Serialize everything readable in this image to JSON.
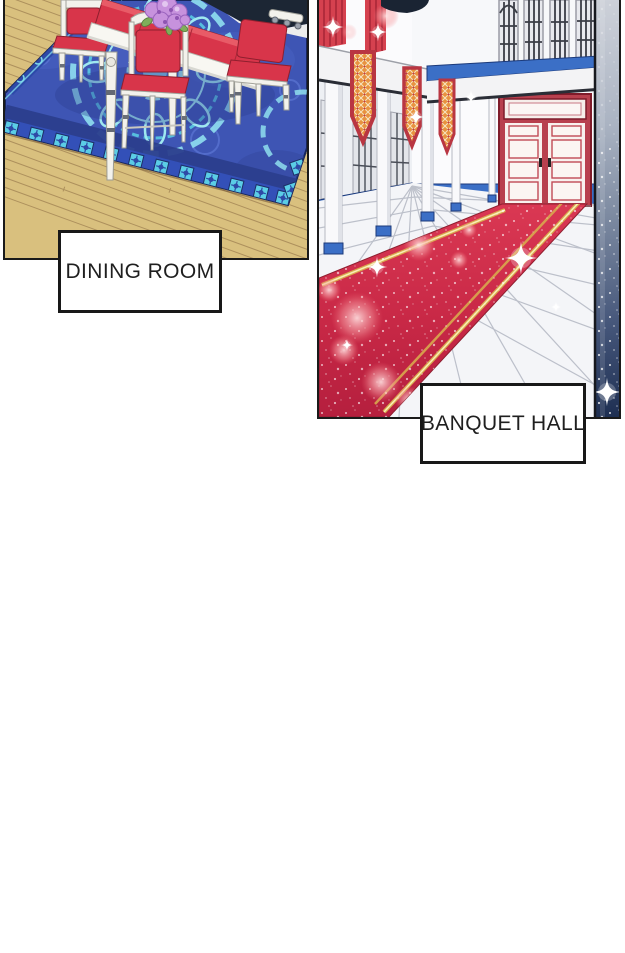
{
  "page": {
    "background": "#ffffff",
    "kind": "comic-page",
    "bottom_area": "blank-white"
  },
  "panels": [
    {
      "id": "dining-room",
      "caption": "DINING ROOM",
      "scene": "dining room with white table and chairs, red cushions, purple flower bouquet, ornate royal-blue carpet with cyan tile border on a tan wooden plank floor"
    },
    {
      "id": "banquet-hall",
      "caption": "BANQUET HALL",
      "scene": "palace banquet hall with white colonnade pillars, hanging orange lattice pennant banners, red curtains, barred windows, red double door, sparkling red carpet with gold trim on white tile floor, starry gradient strip at right edge"
    }
  ],
  "colors": {
    "panel_border": "#1a1a1a",
    "caption_background": "#ffffff",
    "caption_text": "#1f1f1f",
    "floor_tan": "#d9c07e",
    "rug_blue": "#3e55b4",
    "rug_cyan": "#8fdfef",
    "rug_tile_cyan": "#5bcde6",
    "cushion_red": "#d8354a",
    "carpet_red": "#d23347",
    "trim_gold": "#e9c15c",
    "accent_blue": "#3b6fc6",
    "banner_red": "#c23a46",
    "banner_orange": "#e8923e",
    "door_red": "#b8404e",
    "strip_dark": "#1e2f52",
    "sparkle": "#ffffff"
  }
}
